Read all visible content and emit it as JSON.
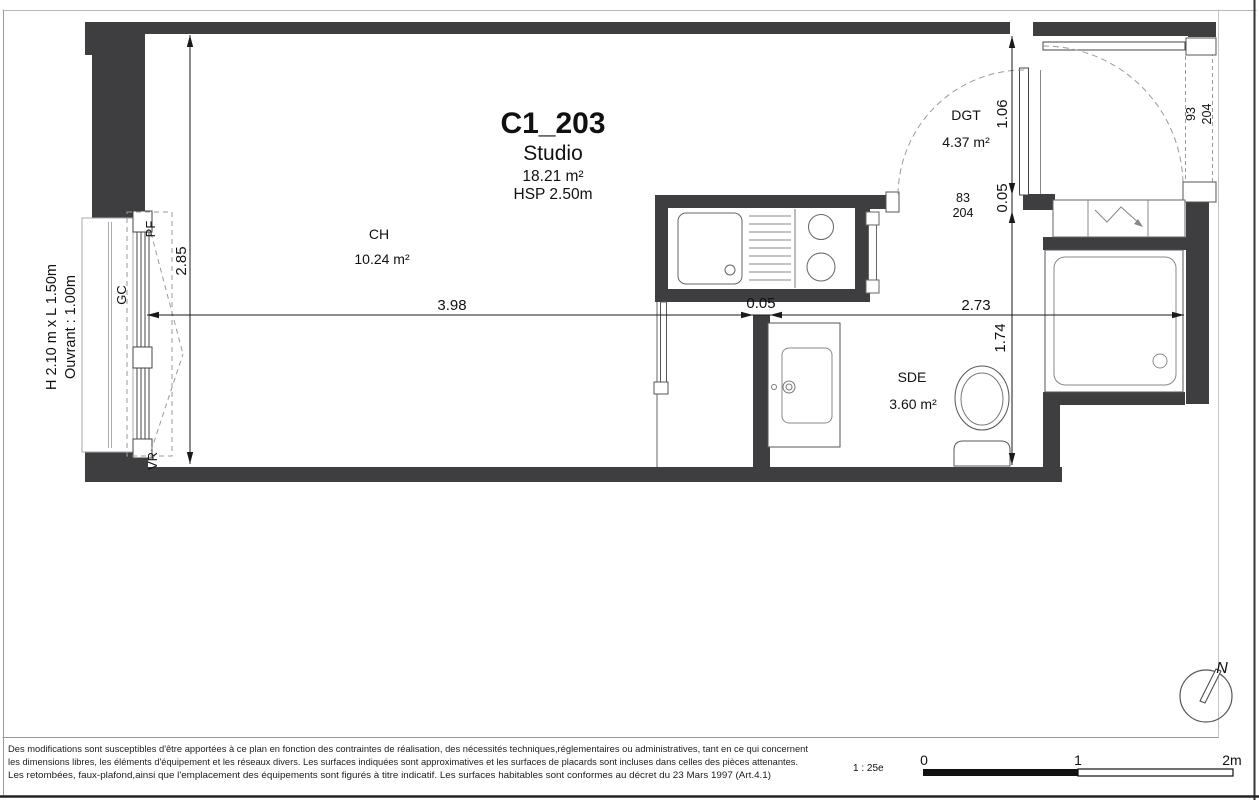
{
  "plan": {
    "unit_id": "C1_203",
    "unit_type": "Studio",
    "unit_area": "18.21 m²",
    "ceiling_height": "HSP 2.50m",
    "rooms": {
      "ch": {
        "code": "CH",
        "area": "10.24 m²"
      },
      "dgt": {
        "code": "DGT",
        "area": "4.37 m²"
      },
      "sde": {
        "code": "SDE",
        "area": "3.60 m²"
      }
    },
    "dims": {
      "left_height": "2.85",
      "main_width": "3.98",
      "wall_thickness": "0.05",
      "right_width": "2.73",
      "sde_height": "1.74",
      "dgt_door_clear": "1.06",
      "dgt_door_gap": "0.05"
    },
    "window": {
      "size_label": "H 2.10 m x L 1.50m",
      "opening_label": "Ouvrant : 1.00m",
      "pf": "PF",
      "gc": "GC",
      "vr": "VR"
    },
    "doors": {
      "sde_w": "83",
      "sde_h": "204",
      "entry_w": "93",
      "entry_h": "204"
    }
  },
  "footer": {
    "disclaimer": [
      "Des modifications sont susceptibles d'être apportées à ce plan en fonction des contraintes de réalisation, des nécessités techniques,réglementaires ou administratives, tant en ce qui concernent",
      "les dimensions libres, les éléments d'équipement et les réseaux divers. Les surfaces indiquées sont approximatives et les surfaces de placards sont incluses dans celles des pièces attenantes.",
      "Les retombées, faux-plafond,ainsi que l'emplacement des équipements sont figurés à titre indicatif. Les surfaces habitables sont conformes au décret du 23 Mars 1997 (Art.4.1)"
    ],
    "scale_label": "1 : 25e",
    "scale_0": "0",
    "scale_1": "1",
    "scale_2": "2m",
    "north": "N"
  },
  "colors": {
    "wall": "#3e3e40",
    "dim": "#1a1a1a",
    "dash": "#9a9a9a"
  }
}
